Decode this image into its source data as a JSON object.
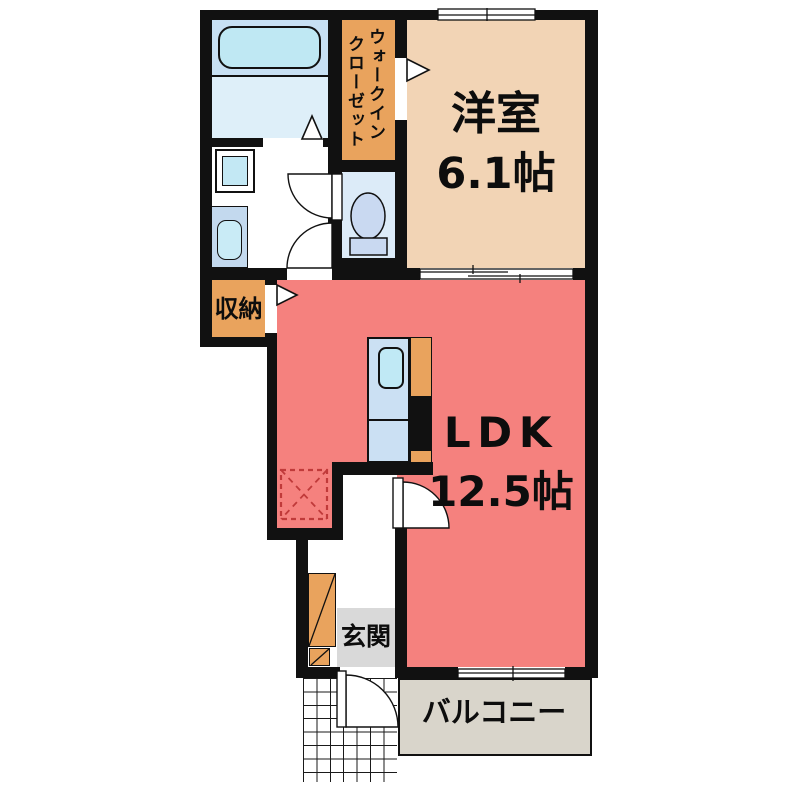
{
  "floor_plan": {
    "western_room": {
      "label": "洋室",
      "size": "6.1帖"
    },
    "ldk": {
      "label": "LDK",
      "size": "12.5帖"
    },
    "walk_in_closet": {
      "column_right": "ウォークイン",
      "column_left": "クローゼット"
    },
    "storage": {
      "label": "収納"
    },
    "entrance": {
      "label": "玄関"
    },
    "balcony": {
      "label": "バルコニー"
    }
  },
  "colors": {
    "wall": "#111111",
    "ldk_floor": "#F5817E",
    "western_room_floor": "#F2D4B5",
    "closet_orange": "#E9A35D",
    "bath_upper": "#C7E0F3",
    "bath_floor": "#DEEFF9",
    "bathtub": "#BFE8F3",
    "toilet_floor": "#DCEBF8",
    "toilet_fixture": "#C9D9F1",
    "washer_square": "#C3E8F4",
    "vanity": "#C3D9EE",
    "vanity_basin": "#C9EBF6",
    "kitchen_counter": "#CBE0F3",
    "kitchen_sink": "#C0E9F5",
    "entrance_floor": "#D9D9D9",
    "balcony_floor": "#D9D5CB",
    "refrigerator_dash": "#C03A3A"
  }
}
